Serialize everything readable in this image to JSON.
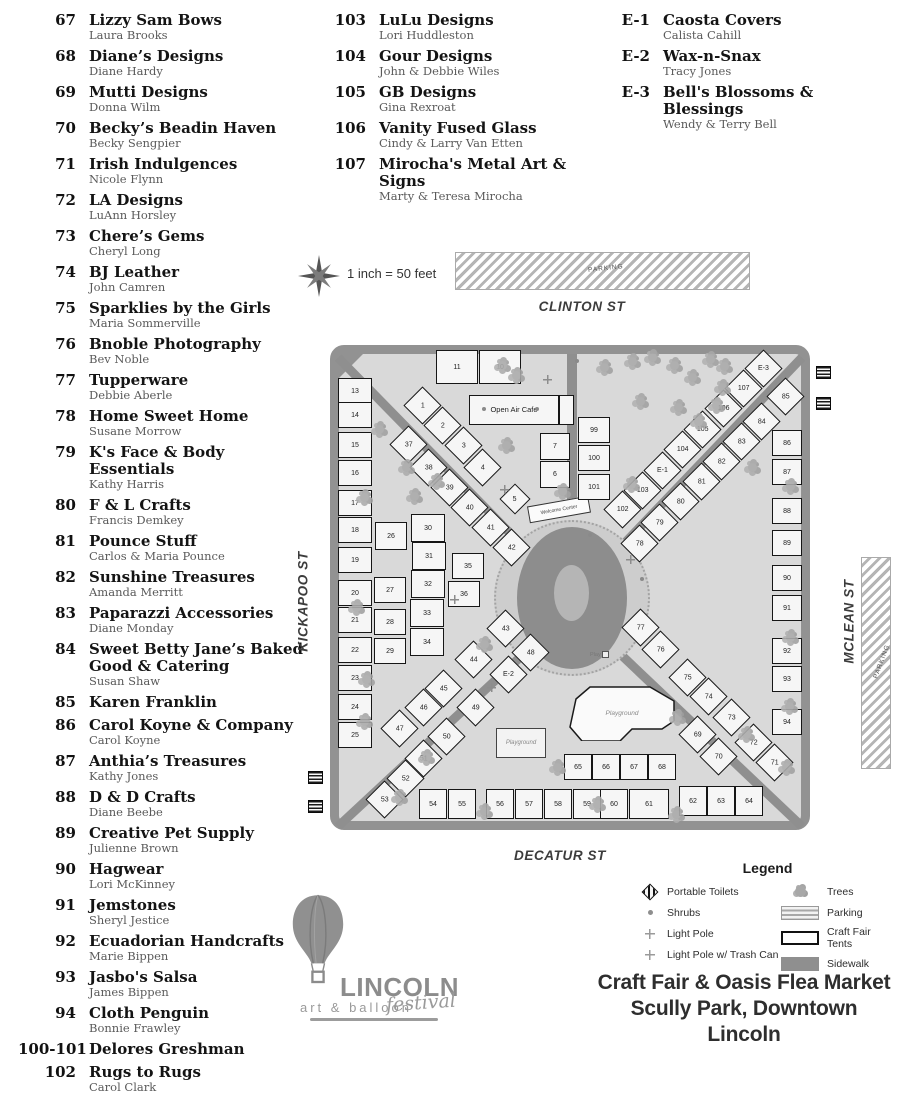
{
  "vendor_list": {
    "columns": [
      {
        "entries": [
          {
            "num": "67",
            "name": "Lizzy Sam Bows",
            "person": "Laura Brooks"
          },
          {
            "num": "68",
            "name": "Diane’s Designs",
            "person": "Diane Hardy"
          },
          {
            "num": "69",
            "name": "Mutti Designs",
            "person": "Donna Wilm"
          },
          {
            "num": "70",
            "name": "Becky’s Beadin Haven",
            "person": "Becky Sengpier"
          },
          {
            "num": "71",
            "name": "Irish Indulgences",
            "person": "Nicole Flynn"
          },
          {
            "num": "72",
            "name": "LA Designs",
            "person": "LuAnn Horsley"
          },
          {
            "num": "73",
            "name": "Chere’s Gems",
            "person": "Cheryl Long"
          },
          {
            "num": "74",
            "name": "BJ Leather",
            "person": "John Camren"
          },
          {
            "num": "75",
            "name": "Sparklies by the Girls",
            "person": "Maria Sommerville"
          },
          {
            "num": "76",
            "name": "Bnoble Photography",
            "person": "Bev Noble"
          },
          {
            "num": "77",
            "name": "Tupperware",
            "person": "Debbie Aberle"
          },
          {
            "num": "78",
            "name": "Home Sweet Home",
            "person": "Susane Morrow"
          },
          {
            "num": "79",
            "name": "K's Face & Body Essentials",
            "person": "Kathy Harris"
          },
          {
            "num": "80",
            "name": "F & L Crafts",
            "person": "Francis Demkey"
          },
          {
            "num": "81",
            "name": "Pounce Stuff",
            "person": "Carlos & Maria Pounce"
          },
          {
            "num": "82",
            "name": "Sunshine Treasures",
            "person": "Amanda Merritt"
          },
          {
            "num": "83",
            "name": "Paparazzi Accessories",
            "person": "Diane Monday"
          },
          {
            "num": "84",
            "name": "Sweet Betty Jane’s Baked Good & Catering",
            "person": "Susan Shaw"
          },
          {
            "num": "85",
            "name": "Karen Franklin"
          },
          {
            "num": "86",
            "name": "Carol Koyne & Company",
            "person": "Carol Koyne"
          },
          {
            "num": "87",
            "name": "Anthia’s Treasures",
            "person": "Kathy Jones"
          },
          {
            "num": "88",
            "name": "D & D Crafts",
            "person": "Diane Beebe"
          },
          {
            "num": "89",
            "name": "Creative Pet Supply",
            "person": "Julienne Brown"
          },
          {
            "num": "90",
            "name": "Hagwear",
            "person": "Lori McKinney"
          },
          {
            "num": "91",
            "name": "Jemstones",
            "person": "Sheryl Jestice"
          },
          {
            "num": "92",
            "name": "Ecuadorian Handcrafts",
            "person": "Marie Bippen"
          },
          {
            "num": "93",
            "name": "Jasbo's Salsa",
            "person": "James Bippen"
          },
          {
            "num": "94",
            "name": "Cloth Penguin",
            "person": "Bonnie Frawley"
          },
          {
            "num": "100-101",
            "name": "Delores Greshman"
          },
          {
            "num": "102",
            "name": "Rugs to Rugs",
            "person": "Carol Clark"
          }
        ]
      },
      {
        "entries": [
          {
            "num": "103",
            "name": "LuLu Designs",
            "person": "Lori Huddleston"
          },
          {
            "num": "104",
            "name": "Gour Designs",
            "person": "John & Debbie Wiles"
          },
          {
            "num": "105",
            "name": "GB Designs",
            "person": "Gina Rexroat"
          },
          {
            "num": "106",
            "name": "Vanity Fused Glass",
            "person": "Cindy & Larry Van Etten"
          },
          {
            "num": "107",
            "name": "Mirocha's Metal Art & Signs",
            "person": "Marty & Teresa Mirocha"
          }
        ]
      },
      {
        "entries": [
          {
            "num": "E-1",
            "name": "Caosta Covers",
            "person": "Calista Cahill"
          },
          {
            "num": "E-2",
            "name": "Wax-n-Snax",
            "person": "Tracy Jones"
          },
          {
            "num": "E-3",
            "name": "Bell's Blossoms & Blessings",
            "person": "Wendy & Terry Bell"
          }
        ]
      }
    ]
  },
  "map": {
    "scale_text": "1 inch = 50 feet",
    "parking_label": "PARKING",
    "streets": {
      "top": "CLINTON ST",
      "left": "KICKAPOO ST",
      "right": "MCLEAN ST",
      "bottom": "DECATUR ST"
    },
    "labels": {
      "cafe": "Open Air Cafe",
      "welcome": "Welcome Center",
      "playground": "Playground",
      "play": "Play"
    },
    "booths": [
      [
        "13",
        25,
        46,
        34,
        26,
        0
      ],
      [
        "14",
        25,
        70,
        34,
        26,
        0
      ],
      [
        "15",
        25,
        100,
        34,
        26,
        0
      ],
      [
        "16",
        25,
        128,
        34,
        26,
        0
      ],
      [
        "17",
        25,
        158,
        34,
        26,
        0
      ],
      [
        "18",
        25,
        185,
        34,
        26,
        0
      ],
      [
        "19",
        25,
        215,
        34,
        26,
        0
      ],
      [
        "20",
        25,
        248,
        34,
        26,
        0
      ],
      [
        "21",
        25,
        275,
        34,
        26,
        0
      ],
      [
        "22",
        25,
        305,
        34,
        26,
        0
      ],
      [
        "23",
        25,
        333,
        34,
        26,
        0
      ],
      [
        "24",
        25,
        362,
        34,
        26,
        0
      ],
      [
        "25",
        25,
        390,
        34,
        26,
        0
      ],
      [
        "11",
        127,
        22,
        42,
        34,
        0
      ],
      [
        "10",
        170,
        22,
        42,
        34,
        0
      ],
      [
        "7",
        225,
        101,
        30,
        27,
        0
      ],
      [
        "6",
        225,
        129,
        30,
        27,
        0
      ],
      [
        "99",
        264,
        85,
        32,
        26,
        0
      ],
      [
        "100",
        264,
        113,
        32,
        26,
        0
      ],
      [
        "101",
        264,
        142,
        32,
        26,
        0
      ],
      [
        "1",
        92,
        60,
        27,
        27,
        45
      ],
      [
        "2",
        112,
        80,
        27,
        27,
        45
      ],
      [
        "3",
        133,
        100,
        27,
        27,
        45
      ],
      [
        "4",
        152,
        122,
        27,
        27,
        45
      ],
      [
        "5",
        185,
        154,
        22,
        22,
        45
      ],
      [
        "37",
        78,
        99,
        27,
        27,
        45
      ],
      [
        "38",
        98,
        122,
        27,
        27,
        45
      ],
      [
        "39",
        119,
        142,
        27,
        27,
        45
      ],
      [
        "40",
        139,
        162,
        27,
        27,
        45
      ],
      [
        "41",
        160,
        182,
        27,
        27,
        45
      ],
      [
        "42",
        181,
        202,
        27,
        27,
        45
      ],
      [
        "26",
        61,
        191,
        32,
        28,
        0
      ],
      [
        "27",
        60,
        245,
        32,
        26,
        0
      ],
      [
        "28",
        60,
        277,
        32,
        26,
        0
      ],
      [
        "29",
        60,
        306,
        32,
        26,
        0
      ],
      [
        "30",
        98,
        183,
        34,
        28,
        0
      ],
      [
        "31",
        99,
        211,
        34,
        28,
        0
      ],
      [
        "32",
        98,
        239,
        34,
        28,
        0
      ],
      [
        "33",
        97,
        268,
        34,
        28,
        0
      ],
      [
        "34",
        97,
        297,
        34,
        28,
        0
      ],
      [
        "35",
        138,
        221,
        32,
        26,
        0
      ],
      [
        "36",
        134,
        249,
        32,
        26,
        0
      ],
      [
        "43",
        175,
        283,
        27,
        27,
        45
      ],
      [
        "44",
        143,
        314,
        27,
        27,
        45
      ],
      [
        "45",
        113,
        343,
        27,
        27,
        45
      ],
      [
        "46",
        93,
        362,
        27,
        27,
        45
      ],
      [
        "47",
        69,
        383,
        27,
        27,
        45
      ],
      [
        "48",
        200,
        307,
        27,
        27,
        45
      ],
      [
        "E-2",
        178,
        329,
        27,
        27,
        45
      ],
      [
        "49",
        145,
        362,
        27,
        27,
        45
      ],
      [
        "50",
        116,
        391,
        27,
        27,
        45
      ],
      [
        "51",
        93,
        413,
        27,
        27,
        45
      ],
      [
        "52",
        75,
        433,
        27,
        27,
        45
      ],
      [
        "53",
        54,
        454,
        27,
        27,
        45
      ],
      [
        "54",
        103,
        459,
        28,
        30,
        0
      ],
      [
        "55",
        132,
        459,
        28,
        30,
        0
      ],
      [
        "56",
        170,
        459,
        28,
        30,
        0
      ],
      [
        "57",
        199,
        459,
        28,
        30,
        0
      ],
      [
        "58",
        228,
        459,
        28,
        30,
        0
      ],
      [
        "59",
        257,
        459,
        28,
        30,
        0
      ],
      [
        "60",
        284,
        459,
        28,
        30,
        0
      ],
      [
        "61",
        319,
        459,
        40,
        30,
        0
      ],
      [
        "62",
        363,
        456,
        28,
        30,
        0
      ],
      [
        "63",
        391,
        456,
        28,
        30,
        0
      ],
      [
        "64",
        419,
        456,
        28,
        30,
        0
      ],
      [
        "65",
        248,
        422,
        28,
        26,
        0
      ],
      [
        "66",
        276,
        422,
        28,
        26,
        0
      ],
      [
        "67",
        304,
        422,
        28,
        26,
        0
      ],
      [
        "68",
        332,
        422,
        28,
        26,
        0
      ],
      [
        "69",
        367,
        389,
        27,
        27,
        45
      ],
      [
        "70",
        388,
        411,
        27,
        27,
        45
      ],
      [
        "77",
        310,
        282,
        27,
        27,
        45
      ],
      [
        "76",
        330,
        304,
        27,
        27,
        45
      ],
      [
        "75",
        357,
        332,
        27,
        27,
        45
      ],
      [
        "74",
        378,
        351,
        27,
        27,
        45
      ],
      [
        "73",
        401,
        372,
        27,
        27,
        45
      ],
      [
        "72",
        423,
        397,
        27,
        27,
        45
      ],
      [
        "71",
        444,
        417,
        27,
        27,
        45
      ],
      [
        "86",
        457,
        98,
        30,
        26,
        0
      ],
      [
        "87",
        457,
        127,
        30,
        26,
        0
      ],
      [
        "88",
        457,
        166,
        30,
        26,
        0
      ],
      [
        "89",
        457,
        198,
        30,
        26,
        0
      ],
      [
        "90",
        457,
        233,
        30,
        26,
        0
      ],
      [
        "91",
        457,
        263,
        30,
        26,
        0
      ],
      [
        "92",
        457,
        306,
        30,
        26,
        0
      ],
      [
        "93",
        457,
        334,
        30,
        26,
        0
      ],
      [
        "94",
        457,
        377,
        30,
        26,
        0
      ],
      [
        "102",
        292,
        164,
        27,
        27,
        45
      ],
      [
        "103",
        312,
        145,
        27,
        27,
        45
      ],
      [
        "E-1",
        332,
        125,
        27,
        27,
        45
      ],
      [
        "104",
        352,
        104,
        27,
        27,
        45
      ],
      [
        "105",
        372,
        84,
        27,
        27,
        45
      ],
      [
        "106",
        393,
        63,
        27,
        27,
        45
      ],
      [
        "107",
        413,
        43,
        27,
        27,
        45
      ],
      [
        "E-3",
        433,
        23,
        27,
        27,
        45
      ],
      [
        "78",
        309,
        198,
        27,
        27,
        45
      ],
      [
        "79",
        329,
        177,
        27,
        27,
        45
      ],
      [
        "80",
        350,
        156,
        27,
        27,
        45
      ],
      [
        "81",
        371,
        136,
        27,
        27,
        45
      ],
      [
        "82",
        391,
        116,
        27,
        27,
        45
      ],
      [
        "83",
        411,
        96,
        27,
        27,
        45
      ],
      [
        "84",
        431,
        76,
        27,
        27,
        45
      ],
      [
        "85",
        455,
        51,
        27,
        27,
        45
      ]
    ],
    "trees": [
      [
        168,
        16
      ],
      [
        182,
        26
      ],
      [
        298,
        12
      ],
      [
        318,
        8
      ],
      [
        340,
        16
      ],
      [
        358,
        28
      ],
      [
        376,
        10
      ],
      [
        388,
        38
      ],
      [
        306,
        52
      ],
      [
        344,
        58
      ],
      [
        382,
        56
      ],
      [
        364,
        72
      ],
      [
        45,
        80
      ],
      [
        72,
        118
      ],
      [
        30,
        148
      ],
      [
        102,
        132
      ],
      [
        172,
        96
      ],
      [
        228,
        142
      ],
      [
        80,
        147
      ],
      [
        270,
        18
      ],
      [
        390,
        17
      ],
      [
        297,
        135
      ],
      [
        418,
        118
      ],
      [
        456,
        137
      ],
      [
        22,
        258
      ],
      [
        32,
        330
      ],
      [
        30,
        372
      ],
      [
        65,
        448
      ],
      [
        92,
        408
      ],
      [
        150,
        295
      ],
      [
        150,
        462
      ],
      [
        223,
        418
      ],
      [
        263,
        455
      ],
      [
        342,
        465
      ],
      [
        343,
        368
      ],
      [
        412,
        385
      ],
      [
        455,
        357
      ],
      [
        456,
        288
      ],
      [
        452,
        418
      ]
    ],
    "shrubs": [
      [
        245,
        14
      ],
      [
        205,
        62
      ],
      [
        258,
        188
      ],
      [
        152,
        62
      ],
      [
        310,
        232
      ]
    ],
    "light_poles": [
      [
        170,
        140
      ],
      [
        157,
        338
      ],
      [
        213,
        30
      ],
      [
        296,
        210
      ],
      [
        120,
        250
      ]
    ],
    "portable_toilets": [
      [
        816,
        366
      ],
      [
        816,
        397
      ],
      [
        308,
        771
      ],
      [
        308,
        800
      ]
    ]
  },
  "legend": {
    "title": "Legend",
    "left_items": [
      {
        "icon": "toilet",
        "label": "Portable Toilets"
      },
      {
        "icon": "shrub",
        "label": "Shrubs"
      },
      {
        "icon": "pole",
        "label": "Light Pole"
      },
      {
        "icon": "pole",
        "label": "Light Pole w/ Trash Can"
      }
    ],
    "right_items": [
      {
        "icon": "tree",
        "label": "Trees"
      },
      {
        "icon": "parking",
        "label": "Parking"
      },
      {
        "icon": "tent",
        "label": "Craft Fair Tents"
      },
      {
        "icon": "sidewalk",
        "label": "Sidewalk"
      }
    ]
  },
  "title": {
    "line1": "Craft Fair & Oasis Flea Market",
    "line2": "Scully Park, Downtown Lincoln"
  },
  "logo": {
    "brand": "LINCOLN",
    "sub": "art & balloon",
    "script": "festival"
  }
}
